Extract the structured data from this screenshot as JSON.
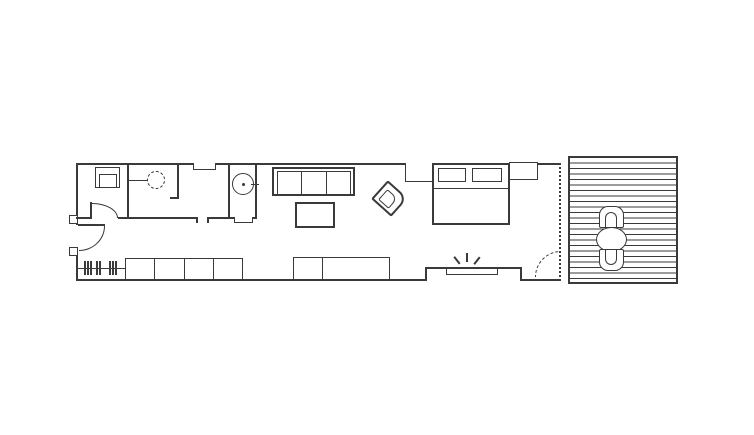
{
  "colors": {
    "background": "#ffffff",
    "line": "#3a3a3a"
  },
  "plan": {
    "type": "architectural-floor-plan",
    "orientation": "long horizontal one-bedroom unit with wood deck on right",
    "areas": [
      {
        "id": "utility-room",
        "features": [
          "toilet-fixture",
          "interior-door-swing"
        ]
      },
      {
        "id": "dressing-room",
        "features": [
          "dashed-circle-fixture-on-wall-arm"
        ]
      },
      {
        "id": "hall",
        "features": [
          "wall-shelf",
          "doorway-gap"
        ]
      },
      {
        "id": "bathroom",
        "features": [
          "round-basin-with-spout",
          "threshold"
        ]
      },
      {
        "id": "living-area",
        "features": [
          "three-seat-sofa",
          "coffee-table",
          "rotated-armchair"
        ]
      },
      {
        "id": "sleeping-area",
        "features": [
          "double-bed",
          "two-pillows",
          "two-nightstands"
        ]
      },
      {
        "id": "entry-hall",
        "features": [
          "entry-door-swing",
          "coat-rack-hatch-marks",
          "cabinet-row",
          "sideboard",
          "media-bench-with-sparkle"
        ]
      },
      {
        "id": "deck",
        "features": [
          "plank-decking",
          "round-table",
          "two-chairs",
          "dotted-glass-wall",
          "dashed-door-swing"
        ]
      }
    ],
    "counts": {
      "sofa_seats": 3,
      "pillows": 2,
      "nightstands": 2,
      "cabinet_sections": 4,
      "sideboard_sections": 2,
      "deck_chairs": 2,
      "deck_planks": 23,
      "coat_rack_ticks": 8,
      "door_swings_solid": 2,
      "door_swings_dashed": 1
    }
  },
  "labels": {
    "plan": "one-bedroom apartment floor plan with deck",
    "unit": "apartment outline",
    "toilet": "toilet fixture",
    "fixture": "dashed circle wall fixture",
    "shelf": "wall shelf",
    "basin": "round basin",
    "sofa": "three-seat sofa",
    "coffee_table": "coffee table",
    "armchair": "rotated armchair",
    "bed": "double bed",
    "pillow": "pillow",
    "nightstand": "nightstand",
    "coat_rack": "coat rack with hatch marks",
    "cabinets": "four-section cabinet row",
    "sideboard": "two-section sideboard",
    "media_bench": "media bench",
    "sparkle": "sparkle highlight symbol",
    "entry_door": "entry door swing",
    "interior_door": "interior door swing",
    "glass_wall": "dotted sliding glass wall",
    "dashed_door": "dashed door swing",
    "deck": "wood plank deck",
    "deck_table": "round outdoor table",
    "deck_chair": "outdoor chair"
  }
}
